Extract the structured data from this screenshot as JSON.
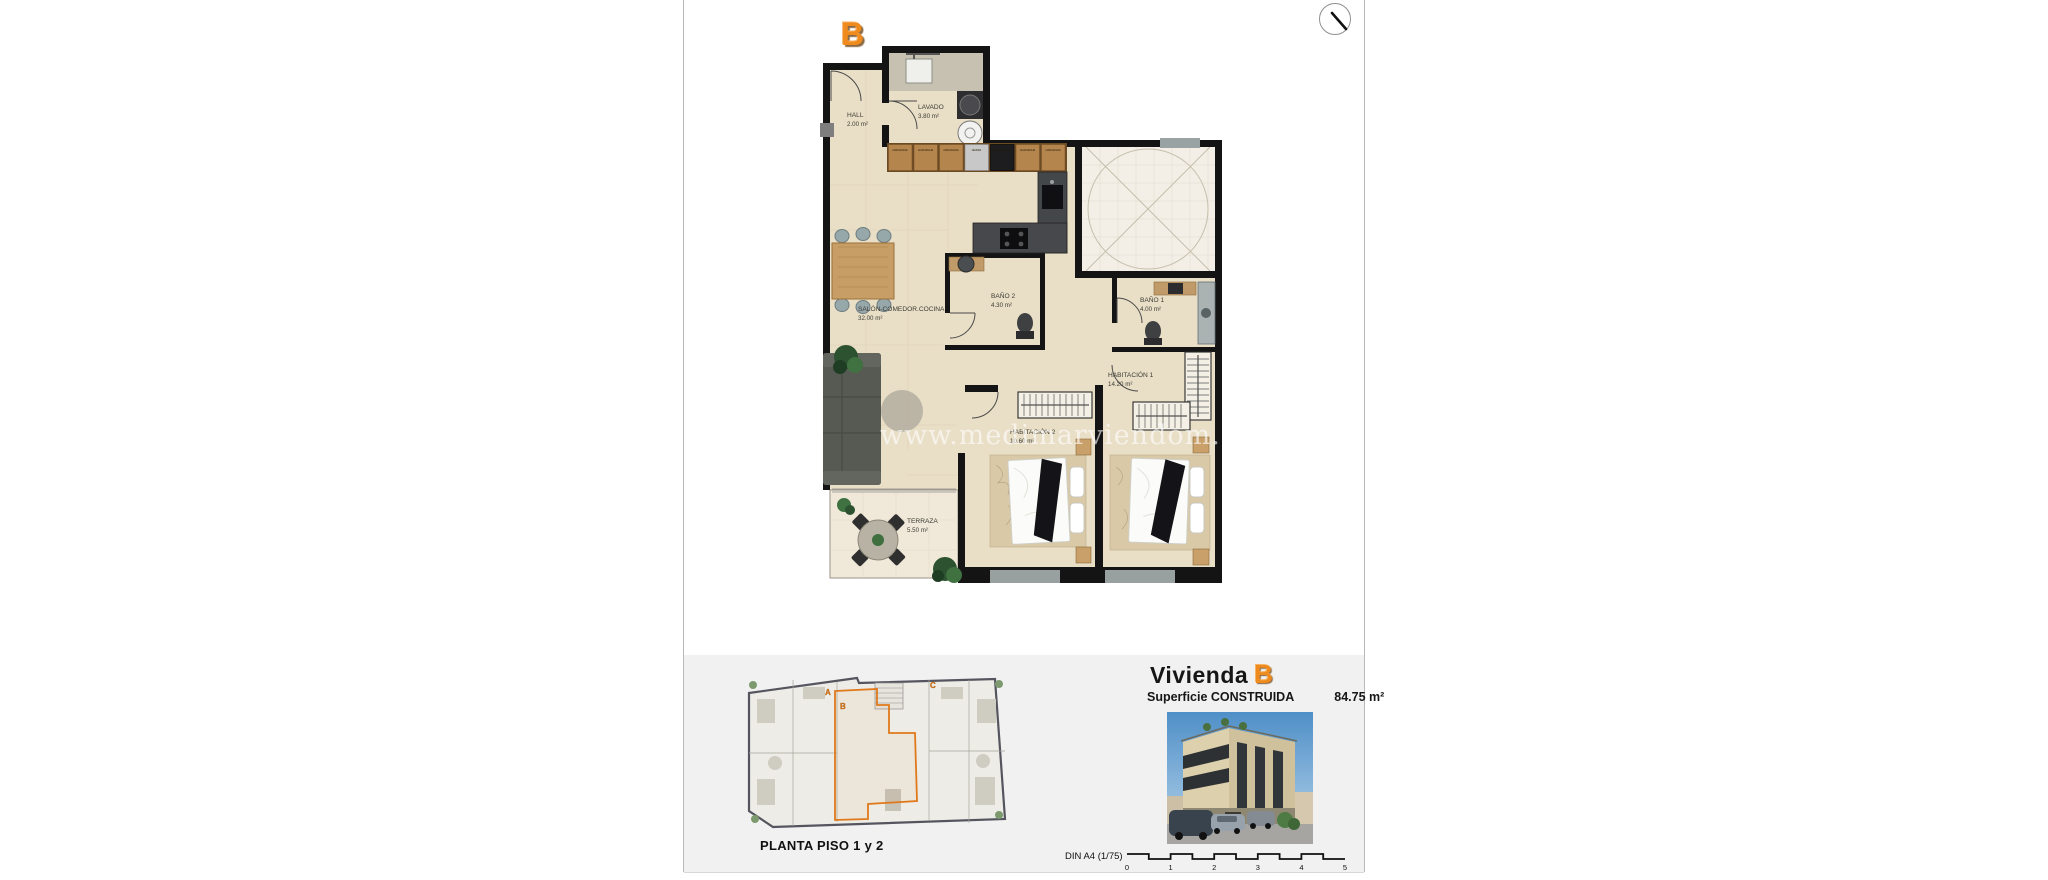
{
  "page": {
    "watermark": "www.medimarviendom.com"
  },
  "plan": {
    "unit_letter": "B",
    "rooms": {
      "hall": {
        "name": "HALL",
        "area": "2.00 m²"
      },
      "lavado": {
        "name": "LAVADO",
        "area": "3.80 m²"
      },
      "salon": {
        "name": "SALÓN-COMEDOR.COCINA",
        "area": "32.00 m²"
      },
      "bano2": {
        "name": "BAÑO 2",
        "area": "4.30 m²"
      },
      "bano1": {
        "name": "BAÑO 1",
        "area": "4.00 m²"
      },
      "habitacion1": {
        "name": "HABITACIÓN 1",
        "area": "14.20 m²"
      },
      "habitacion2": {
        "name": "HABITACIÓN 2",
        "area": "10.60 m²"
      },
      "terraza": {
        "name": "TERRAZA",
        "area": "5.50 m²"
      }
    },
    "kitchen_cabinets": [
      "ALMACENAJE",
      "ALMACENAJE",
      "ALMACENAJE",
      "NEVERA",
      "HORNO MICRO",
      "ALMACENAJE",
      "ALMACENAJE"
    ]
  },
  "footer": {
    "key_plan_label": "PLANTA PISO 1 y 2",
    "key_letters": [
      "A",
      "B",
      "C"
    ],
    "title_prefix": "Vivienda",
    "title_letter": "B",
    "surface_label": "Superficie CONSTRUIDA",
    "surface_value": "84.75 m²",
    "scale_label": "DIN A4 (1/75)",
    "scale_ticks": [
      "0",
      "1",
      "2",
      "3",
      "4",
      "5"
    ]
  },
  "colors": {
    "accent_orange": "#ef8a1d",
    "wall_black": "#141414",
    "floor_beige": "#e9dec6",
    "terrace_beige": "#f0e9d9",
    "patio_white": "#f3efe6",
    "footer_band_gray": "#f1f1f1",
    "page_border_gray": "#b9b9b9"
  }
}
